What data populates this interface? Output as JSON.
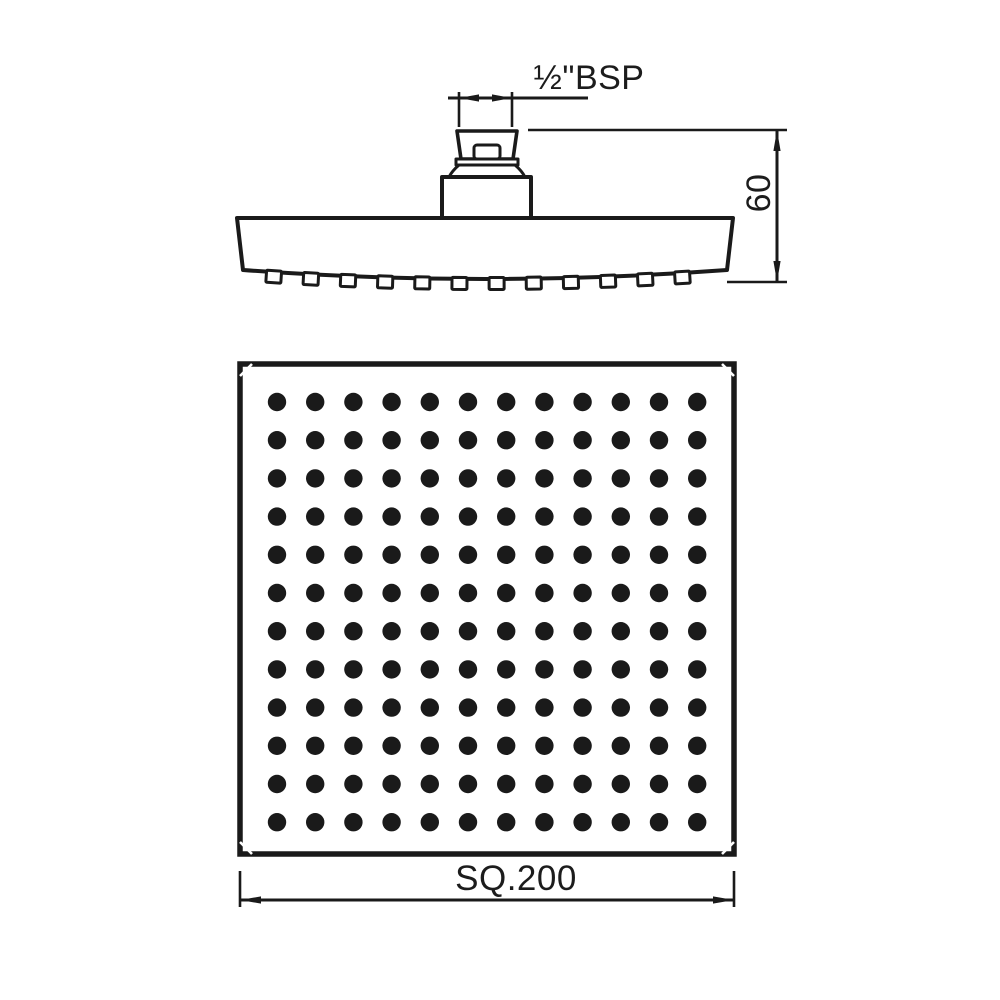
{
  "meta": {
    "background": "#ffffff",
    "line_color": "#1a1a1a"
  },
  "side_view": {
    "thread_label": "½\"BSP",
    "height_dimension": "60",
    "nozzle_count": 12
  },
  "face_view": {
    "size_dimension": "SQ.200",
    "grid_rows": 12,
    "grid_cols": 12,
    "spray_hole_count": 144
  }
}
